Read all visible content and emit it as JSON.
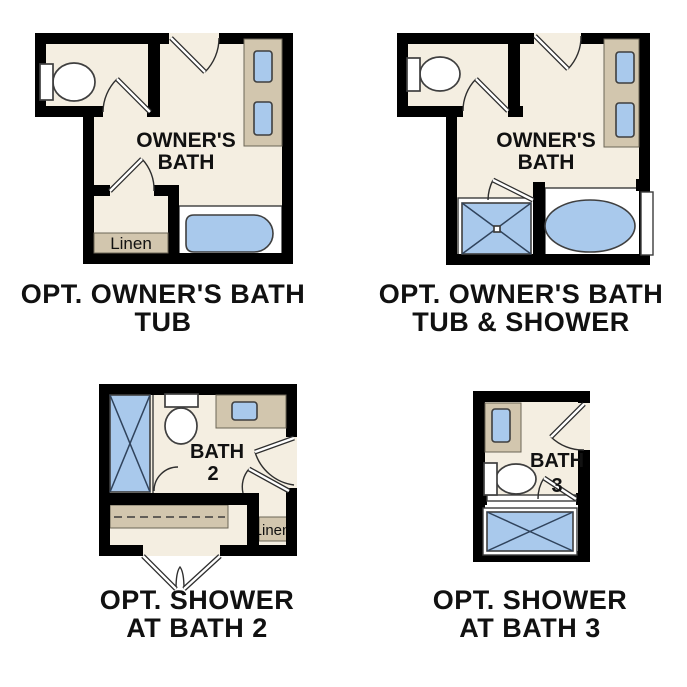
{
  "colors": {
    "background": "#ffffff",
    "wall": "#000000",
    "floor": "#f4eee1",
    "counter": "#d2c6ae",
    "blue": "#a9c9ec",
    "outline": "#3c3c3c",
    "label": "#111111"
  },
  "plans": [
    {
      "id": "owner-bath-tub",
      "room_label": [
        "OWNER'S",
        "BATH"
      ],
      "closet_label": "Linen",
      "caption": [
        "OPT. OWNER'S BATH",
        "TUB"
      ]
    },
    {
      "id": "owner-bath-tub-shower",
      "room_label": [
        "OWNER'S",
        "BATH"
      ],
      "caption": [
        "OPT. OWNER'S BATH",
        "TUB & SHOWER"
      ]
    },
    {
      "id": "shower-at-bath-2",
      "room_label": [
        "BATH",
        "2"
      ],
      "closet_label": "Linen",
      "caption": [
        "OPT. SHOWER",
        "AT BATH 2"
      ]
    },
    {
      "id": "shower-at-bath-3",
      "room_label": [
        "BATH",
        "3"
      ],
      "caption": [
        "OPT. SHOWER",
        "AT BATH 3"
      ]
    }
  ]
}
